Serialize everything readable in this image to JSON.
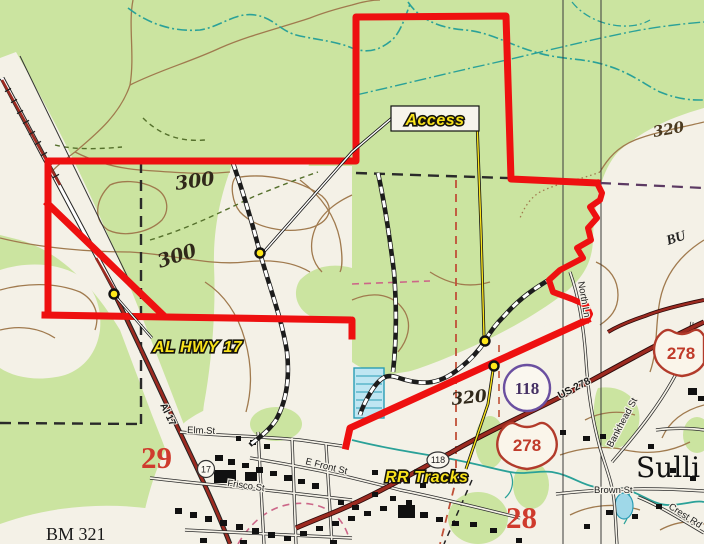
{
  "map": {
    "callouts": {
      "access": "Access",
      "al_hwy_17": "AL HWY 17",
      "rr_tracks": "RR Tracks"
    },
    "contour_labels": {
      "left_upper": "300",
      "left_lower": "300",
      "top_right": "320",
      "center": "320"
    },
    "section_numbers": {
      "west": "29",
      "east": "28"
    },
    "benchmark": "BM 321",
    "shields": {
      "state_circle_large": "118",
      "state_circle_small": "118",
      "state_circle_17": "17",
      "us_shield_center": "278",
      "us_shield_east": "278",
      "us_road_label": "US 278"
    },
    "streets": {
      "elm": "Elm St",
      "frisco": "Frisco St",
      "e_front": "E Front St",
      "brown": "Brown St",
      "bankhead": "Bankhead St",
      "north_ln": "North Ln",
      "crest": "Crest Rd",
      "al17_road": "Al 17"
    },
    "places": {
      "town_partial": "Sulli",
      "edge_partial": "BU"
    },
    "colors": {
      "woodland": "#cbe4a0",
      "open_land": "#f4f1e7",
      "boundary_red": "#ee1010",
      "highway_maroon": "#9c2a20",
      "contour_brown": "#a07a4e",
      "stream_teal": "#2aa198",
      "callout_yellow": "#f9e31c",
      "section_red": "#cf3b2d",
      "shield_purple": "#6a4fa0"
    }
  }
}
